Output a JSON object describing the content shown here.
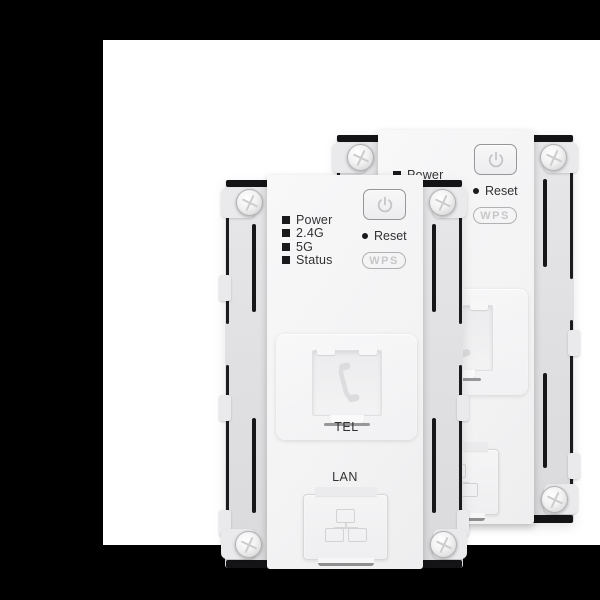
{
  "scene": {
    "description": "Product render: two white in-wall Wi-Fi access point modules (front and rear) with TEL and LAN ports, on a white card over a black background",
    "colors": {
      "canvas_bg": "#000000",
      "photo_bg": "#ffffff",
      "faceplate": "#f4f4f5",
      "frame": "#e1e1e3",
      "frame_edge": "#17171a",
      "label_text": "#323234",
      "muted_control": "#c7c7c9"
    }
  },
  "icons": {
    "power": "power-standby-icon",
    "tel": "phone-handset-icon",
    "lan": "network-nodes-icon",
    "screw": "screw-head-icon",
    "led": "led-square-icon",
    "reset": "reset-pinhole-icon"
  },
  "devices": {
    "front": {
      "leds": [
        "Power",
        "2.4G",
        "5G",
        "Status"
      ],
      "reset_label": "Reset",
      "wps_label": "WPS",
      "tel_port_label": "TEL",
      "lan_port_label": "LAN"
    },
    "back": {
      "power_led_label": "Power",
      "reset_label": "Reset",
      "wps_label": "WPS"
    }
  }
}
